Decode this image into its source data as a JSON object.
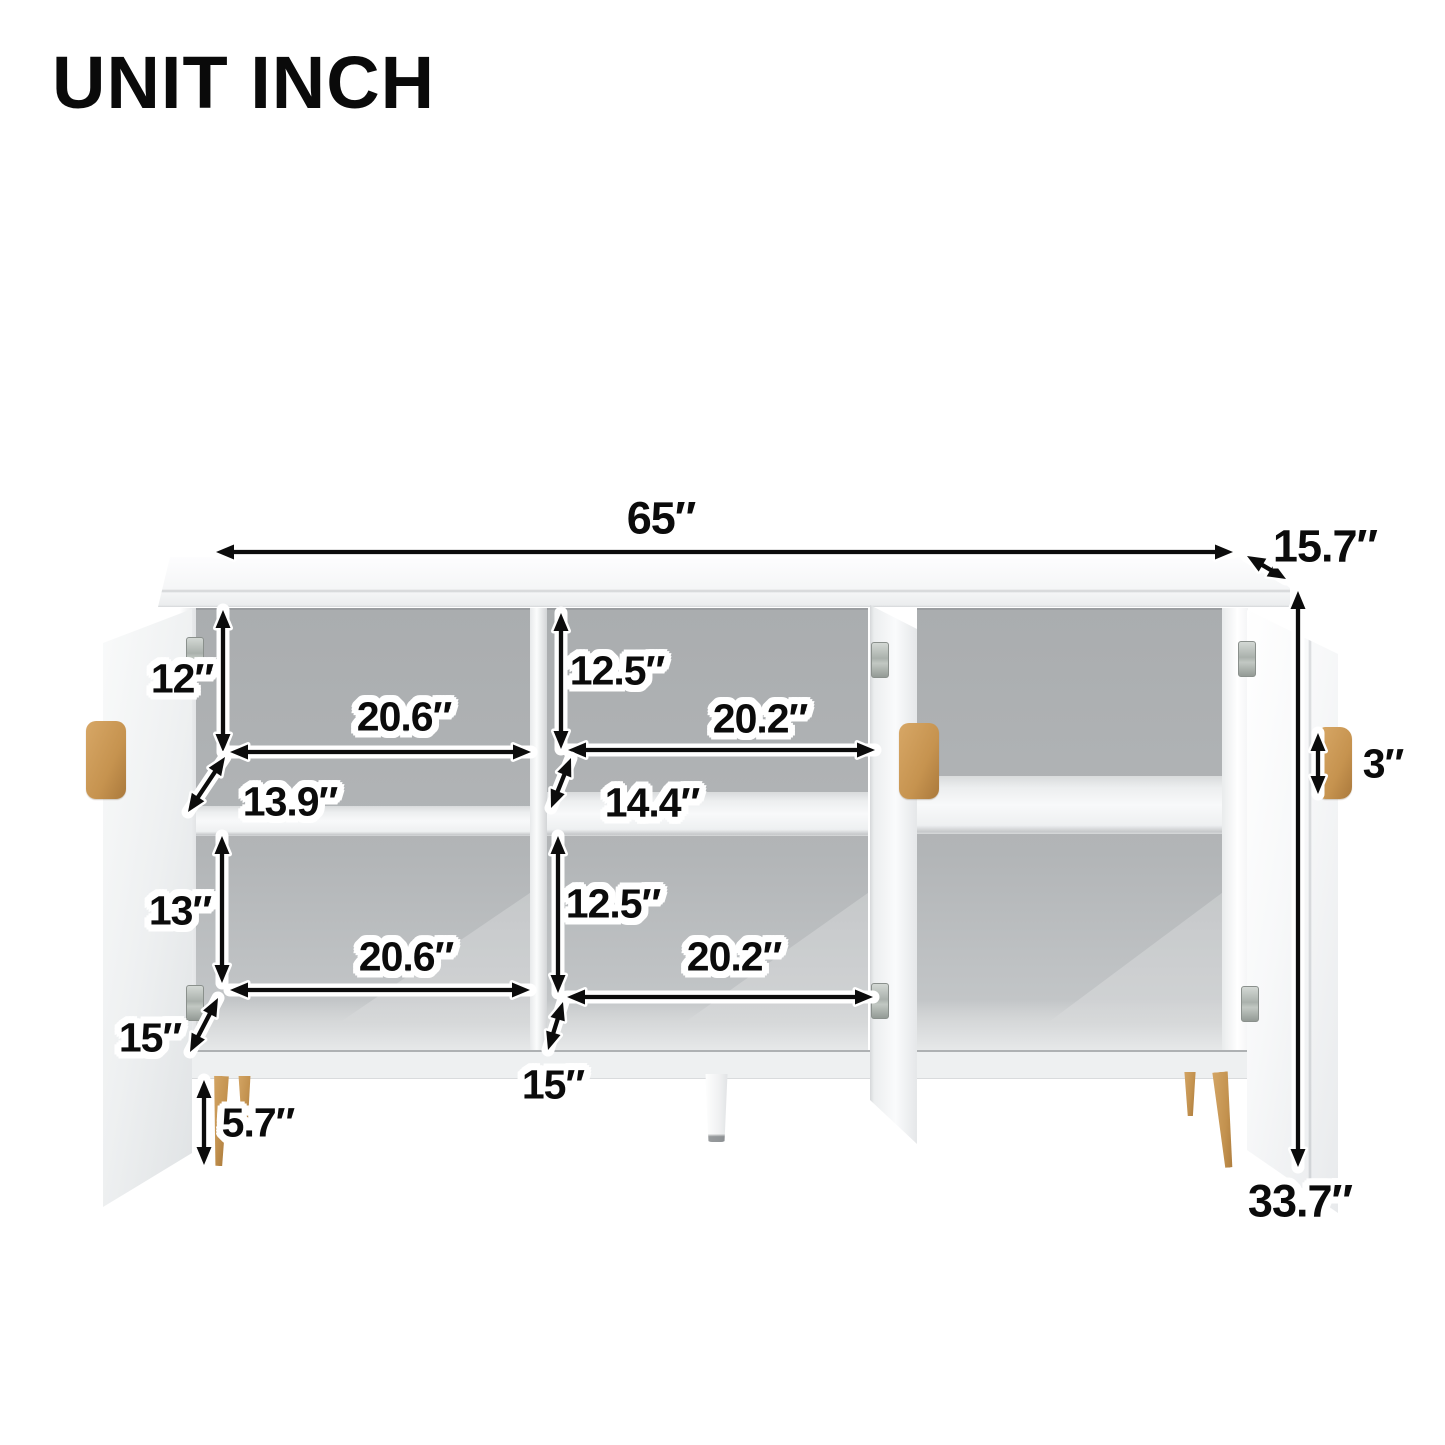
{
  "title": "UNIT INCH",
  "colors": {
    "accent_gold": "#C6934F",
    "interior_gray": "#B2B5B7",
    "arrow": "#0B0B0B"
  },
  "dimensions": {
    "overall_width": "65″",
    "overall_depth": "15.7″",
    "overall_height": "33.7″",
    "door_handle_height": "3″",
    "leg_height": "5.7″"
  },
  "cells": {
    "left_top": {
      "height": "12″",
      "width": "20.6″",
      "depth": "13.9″"
    },
    "middle_top": {
      "height": "12.5″",
      "width": "20.2″",
      "depth": "14.4″"
    },
    "left_bottom": {
      "height": "13″",
      "width": "20.6″",
      "depth": "15″"
    },
    "middle_bottom": {
      "height": "12.5″",
      "width": "20.2″",
      "depth": "15″"
    }
  }
}
